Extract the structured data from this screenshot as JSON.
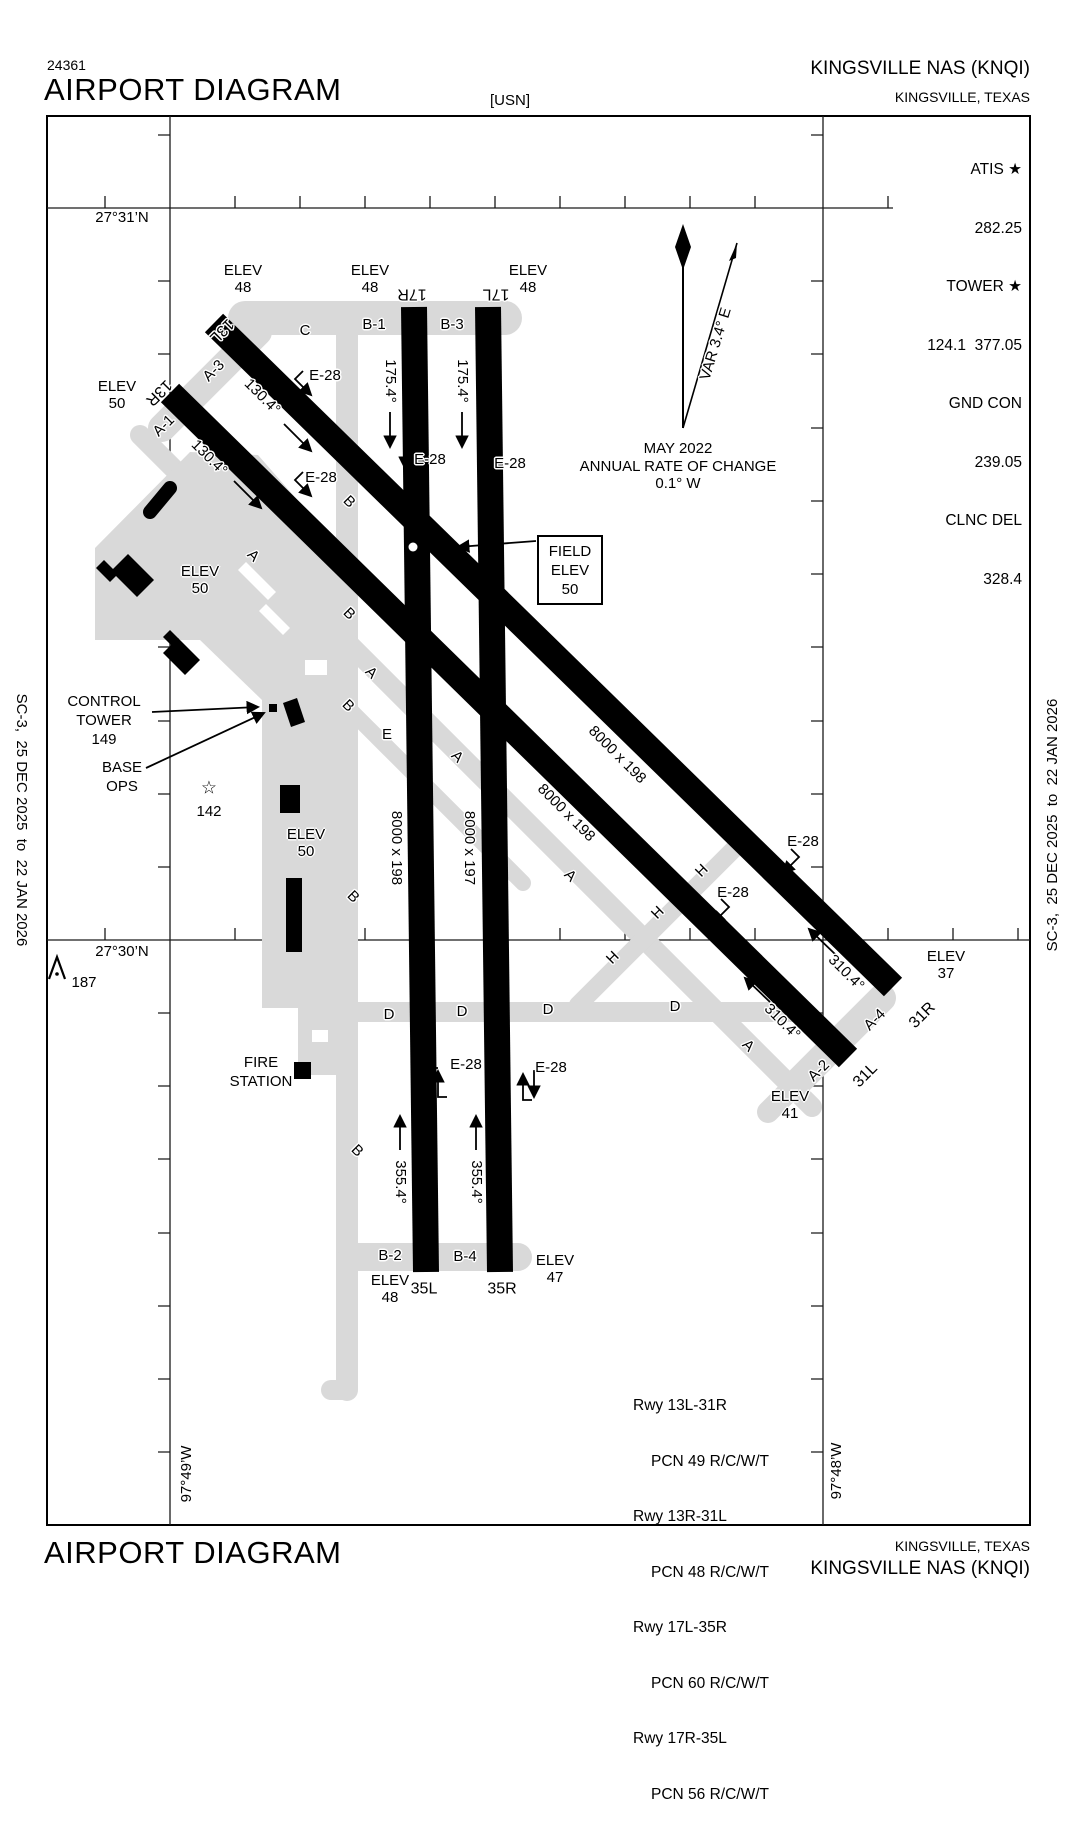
{
  "header": {
    "chart_number": "24361",
    "title": "AIRPORT DIAGRAM",
    "org": "[USN]",
    "airport": "KINGSVILLE NAS  (KNQI)",
    "city": "KINGSVILLE, TEXAS"
  },
  "footer": {
    "title": "AIRPORT DIAGRAM",
    "city": "KINGSVILLE, TEXAS",
    "airport": "KINGSVILLE NAS  (KNQI)"
  },
  "edges": {
    "left": "SC-3,  25 DEC 2025  to  22 JAN 2026",
    "right": "SC-3,  25 DEC 2025  to  22 JAN 2026"
  },
  "comm": {
    "lines": [
      "ATIS ★",
      "282.25",
      "TOWER ★",
      "124.1  377.05",
      "GND CON",
      "239.05",
      "CLNC DEL",
      "328.4"
    ]
  },
  "graticule": {
    "lat_top": "27°31’N",
    "lat_bottom": "27°30’N",
    "lon_left": "97°49’W",
    "lon_right": "97°48’W"
  },
  "magvar": {
    "var_label": "VAR 3.4° E",
    "date": "MAY 2022",
    "rate_line1": "ANNUAL RATE OF CHANGE",
    "rate_line2": "0.1° W"
  },
  "field_elev": {
    "line1": "FIELD",
    "line2": "ELEV",
    "line3": "50"
  },
  "elev": {
    "label": "ELEV",
    "rwy13l": "48",
    "rwy17r": "48",
    "rwy17l": "48",
    "rwy13r": "50",
    "apron": "50",
    "tank": "50",
    "rwy31r": "37",
    "rwy31l": "41",
    "rwy35l": "48",
    "rwy35r": "47"
  },
  "runway_ends": {
    "r13l": "13L",
    "r13r": "13R",
    "r17r": "17R",
    "r17l": "17L",
    "r31r": "31R",
    "r31l": "31L",
    "r35l": "35L",
    "r35r": "35R"
  },
  "headings": {
    "h130": "130.4°",
    "h175": "175.4°",
    "h310": "310.4°",
    "h355": "355.4°"
  },
  "dimensions": {
    "rwy_198": "8000 x 198",
    "rwy_197": "8000 x 197"
  },
  "taxiways": {
    "a": "A",
    "b": "B",
    "c": "C",
    "d": "D",
    "e": "E",
    "h": "H",
    "a1": "A-1",
    "a2": "A-2",
    "a3": "A-3",
    "a4": "A-4",
    "b1": "B-1",
    "b2": "B-2",
    "b3": "B-3",
    "b4": "B-4"
  },
  "hold_marking": "E-28",
  "annotations": {
    "control_tower": "CONTROL\nTOWER\n149",
    "base_ops": "BASE\nOPS",
    "fire_station": "FIRE\nSTATION",
    "beacon": "142",
    "obstruction": "187"
  },
  "icons": {
    "beacon_star": "☆"
  },
  "pcn": {
    "lines": [
      "Rwy 13L-31R",
      "PCN 49 R/C/W/T",
      "Rwy 13R-31L",
      "PCN 48 R/C/W/T",
      "Rwy 17L-35R",
      "PCN 60 R/C/W/T",
      "Rwy 17R-35L",
      "PCN 56 R/C/W/T"
    ]
  }
}
